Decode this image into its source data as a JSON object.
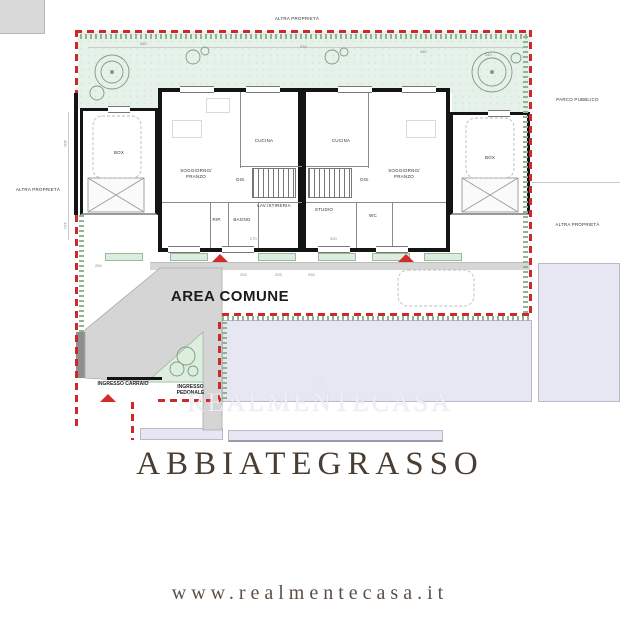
{
  "plan": {
    "boundary_labels": {
      "top": "ALTRA PROPRIETÀ",
      "left": "ALTRA PROPRIETÀ",
      "right_top": "PARCO PUBBLICO",
      "right_bottom": "ALTRA PROPRIETÀ"
    },
    "rooms": {
      "box_left": "BOX",
      "soggiorno_left_1": "SOGGIORNO/",
      "soggiorno_left_2": "PRANZO",
      "cucina_left": "CUCINA",
      "dis_left": "DIS.",
      "rip_left": "RIP.",
      "bagno_left": "BAGNO",
      "lav_left": "LAV./STIRERIA",
      "cucina_right": "CUCINA",
      "soggiorno_right_1": "SOGGIORNO/",
      "soggiorno_right_2": "PRANZO",
      "dis_right": "DIS.",
      "studio_right": "STUDIO",
      "wc_right": "WC",
      "box_right": "BOX"
    },
    "areas": {
      "area_comune": "AREA COMUNE",
      "ingresso_carraio": "INGRESSO CARRAIO",
      "ingresso_pedonale_1": "INGRESSO",
      "ingresso_pedonale_2": "PEDONALE"
    },
    "dimensions": [
      "580",
      "935",
      "480",
      "240",
      "250",
      "200",
      "225",
      "250",
      "270",
      "300",
      "400",
      "120"
    ]
  },
  "watermark": {
    "crown": "♔",
    "text": "REALMENTECASA"
  },
  "branding": {
    "city": "ABBIATEGRASSO",
    "website": "www.realmentecasa.it"
  },
  "colors": {
    "boundary_red": "#cc2a2a",
    "garden_green": "#e6f2e9",
    "hedge_green": "#8fb394",
    "area_gray": "#d6d6d6",
    "neighbor_lavender": "#e7e7f3",
    "wall_black": "#141414",
    "brand_brown": "#4a3e33"
  }
}
